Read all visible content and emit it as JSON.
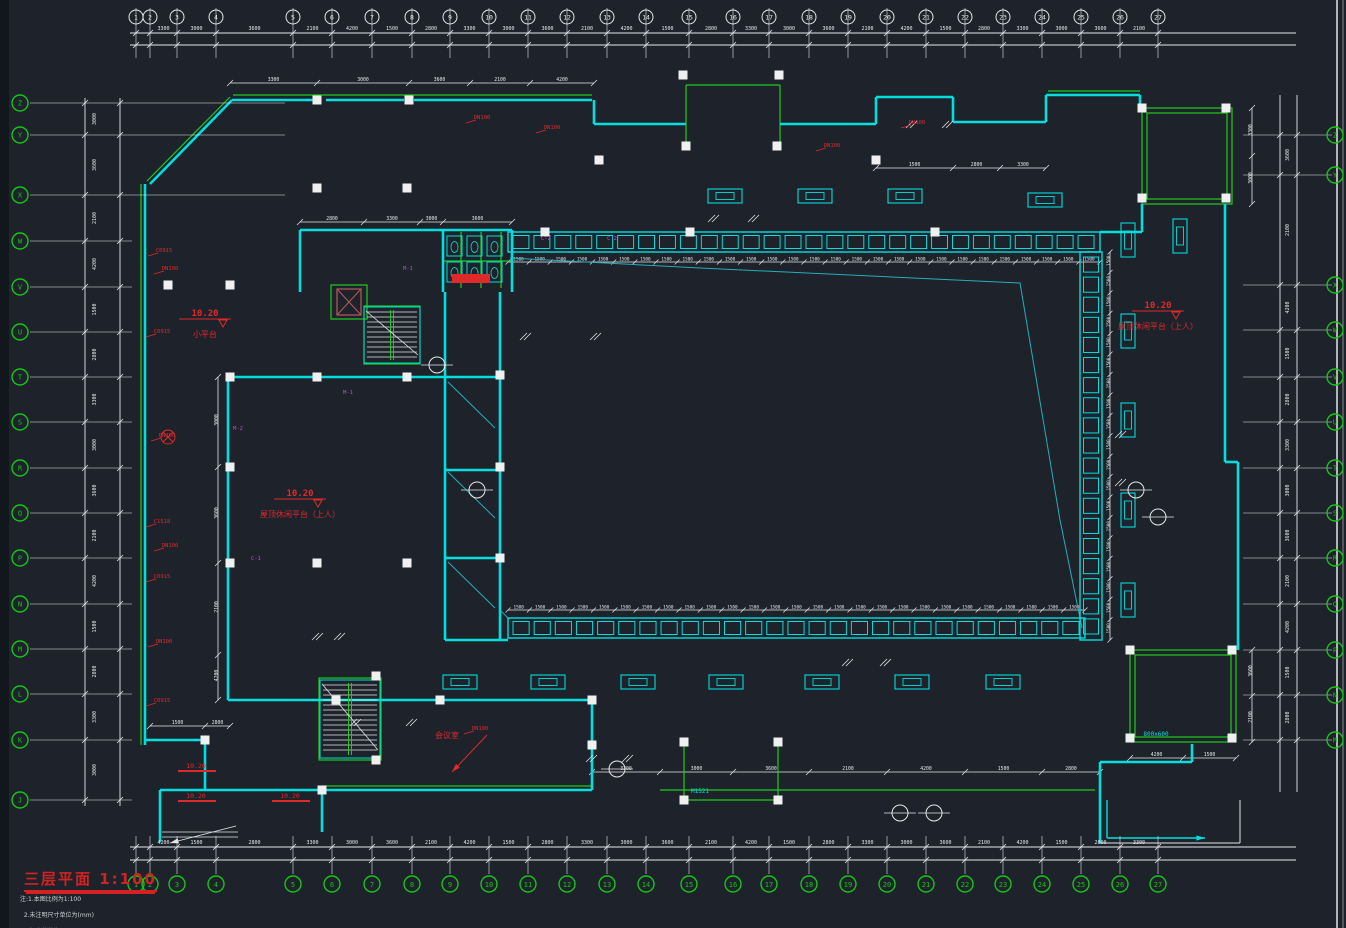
{
  "drawing": {
    "title": "三层平面 1:100",
    "notes": [
      "注:1.本图比例为1:100",
      "2.未注明尺寸单位为(mm)",
      "3.标高单位为(m)"
    ],
    "colors": {
      "background": "#1d222b",
      "wall_cyan": "#00dede",
      "detail_green": "#1ecb1e",
      "axis_green": "#17c517",
      "dim_white": "#e8e8ec",
      "anno_red": "#e02a2a",
      "tag_magenta": "#c24ac2",
      "title_red": "#d42222"
    },
    "axes": {
      "top": {
        "labels": [
          "1",
          "2",
          "3",
          "4",
          "5",
          "6",
          "7",
          "8",
          "9",
          "10",
          "11",
          "12",
          "13",
          "14",
          "15",
          "16",
          "17",
          "18",
          "19",
          "20",
          "21",
          "22",
          "23",
          "24",
          "25",
          "26",
          "27"
        ],
        "x": [
          136,
          150,
          177,
          216,
          293,
          332,
          372,
          412,
          450,
          489,
          528,
          567,
          607,
          646,
          689,
          733,
          769,
          809,
          848,
          887,
          926,
          965,
          1003,
          1042,
          1081,
          1120,
          1158
        ]
      },
      "bottom": {
        "labels": [
          "1",
          "2",
          "3",
          "4",
          "5",
          "6",
          "7",
          "8",
          "9",
          "10",
          "11",
          "12",
          "13",
          "14",
          "15",
          "16",
          "17",
          "18",
          "19",
          "20",
          "21",
          "22",
          "23",
          "24",
          "25",
          "26",
          "27"
        ],
        "x": [
          136,
          150,
          177,
          216,
          293,
          332,
          372,
          412,
          450,
          489,
          528,
          567,
          607,
          646,
          689,
          733,
          769,
          809,
          848,
          887,
          926,
          965,
          1003,
          1042,
          1081,
          1120,
          1158
        ]
      },
      "left": {
        "labels": [
          "Z",
          "Y",
          "X",
          "W",
          "V",
          "U",
          "T",
          "S",
          "R",
          "Q",
          "P",
          "N",
          "M",
          "L",
          "K",
          "J"
        ],
        "y": [
          103,
          135,
          195,
          241,
          287,
          332,
          377,
          422,
          468,
          513,
          558,
          604,
          649,
          694,
          740,
          800
        ]
      },
      "right": {
        "labels": [
          "Z",
          "Y",
          "X",
          "W",
          "V",
          "U",
          "T",
          "S",
          "R",
          "Q",
          "P",
          "N",
          "M"
        ],
        "y": [
          135,
          175,
          285,
          330,
          377,
          422,
          468,
          513,
          558,
          604,
          650,
          695,
          740
        ]
      }
    },
    "elevation_labels": [
      {
        "value": "10.20",
        "desc": "小平台",
        "x": 205,
        "y": 316
      },
      {
        "value": "10.20",
        "desc": "屋顶休闲平台（上人）",
        "x": 300,
        "y": 496
      },
      {
        "value": "10.20",
        "desc": "屋顶休闲平台（上人）",
        "x": 1158,
        "y": 308
      }
    ],
    "porch_levels": [
      {
        "value": "10.20",
        "x": 178,
        "y": 768
      },
      {
        "value": "10.20",
        "x": 178,
        "y": 798
      },
      {
        "value": "10.20",
        "x": 272,
        "y": 798
      }
    ],
    "room_labels": [
      {
        "text": "会议室",
        "x": 447,
        "y": 738
      }
    ],
    "wall_tags_red": [
      {
        "text": "DN100",
        "x": 470,
        "y": 119
      },
      {
        "text": "DN100",
        "x": 540,
        "y": 129
      },
      {
        "text": "DN100",
        "x": 820,
        "y": 147
      },
      {
        "text": "DN100",
        "x": 905,
        "y": 124
      },
      {
        "text": "C0915",
        "x": 152,
        "y": 252
      },
      {
        "text": "DN100",
        "x": 158,
        "y": 270
      },
      {
        "text": "C0915",
        "x": 150,
        "y": 333
      },
      {
        "text": "DN100",
        "x": 155,
        "y": 437
      },
      {
        "text": "C1518",
        "x": 150,
        "y": 523
      },
      {
        "text": "DN100",
        "x": 158,
        "y": 547
      },
      {
        "text": "C0915",
        "x": 150,
        "y": 578
      },
      {
        "text": "DN100",
        "x": 152,
        "y": 643
      },
      {
        "text": "C0915",
        "x": 150,
        "y": 702
      },
      {
        "text": "DN100",
        "x": 468,
        "y": 730
      }
    ],
    "tags_magenta": [
      {
        "text": "M-1",
        "x": 408,
        "y": 270
      },
      {
        "text": "C-2",
        "x": 546,
        "y": 240
      },
      {
        "text": "C-2",
        "x": 612,
        "y": 240
      },
      {
        "text": "M-2",
        "x": 238,
        "y": 430
      },
      {
        "text": "C-1",
        "x": 256,
        "y": 560
      },
      {
        "text": "M-1",
        "x": 348,
        "y": 394
      }
    ],
    "tags_cyan": [
      {
        "text": "M1521",
        "x": 700,
        "y": 793
      },
      {
        "text": "800x600",
        "x": 1156,
        "y": 736
      }
    ],
    "dim_values": [
      "3300",
      "3000",
      "3600",
      "2100",
      "4200",
      "1500",
      "2800"
    ],
    "colonnade_dim_value": "1500"
  }
}
